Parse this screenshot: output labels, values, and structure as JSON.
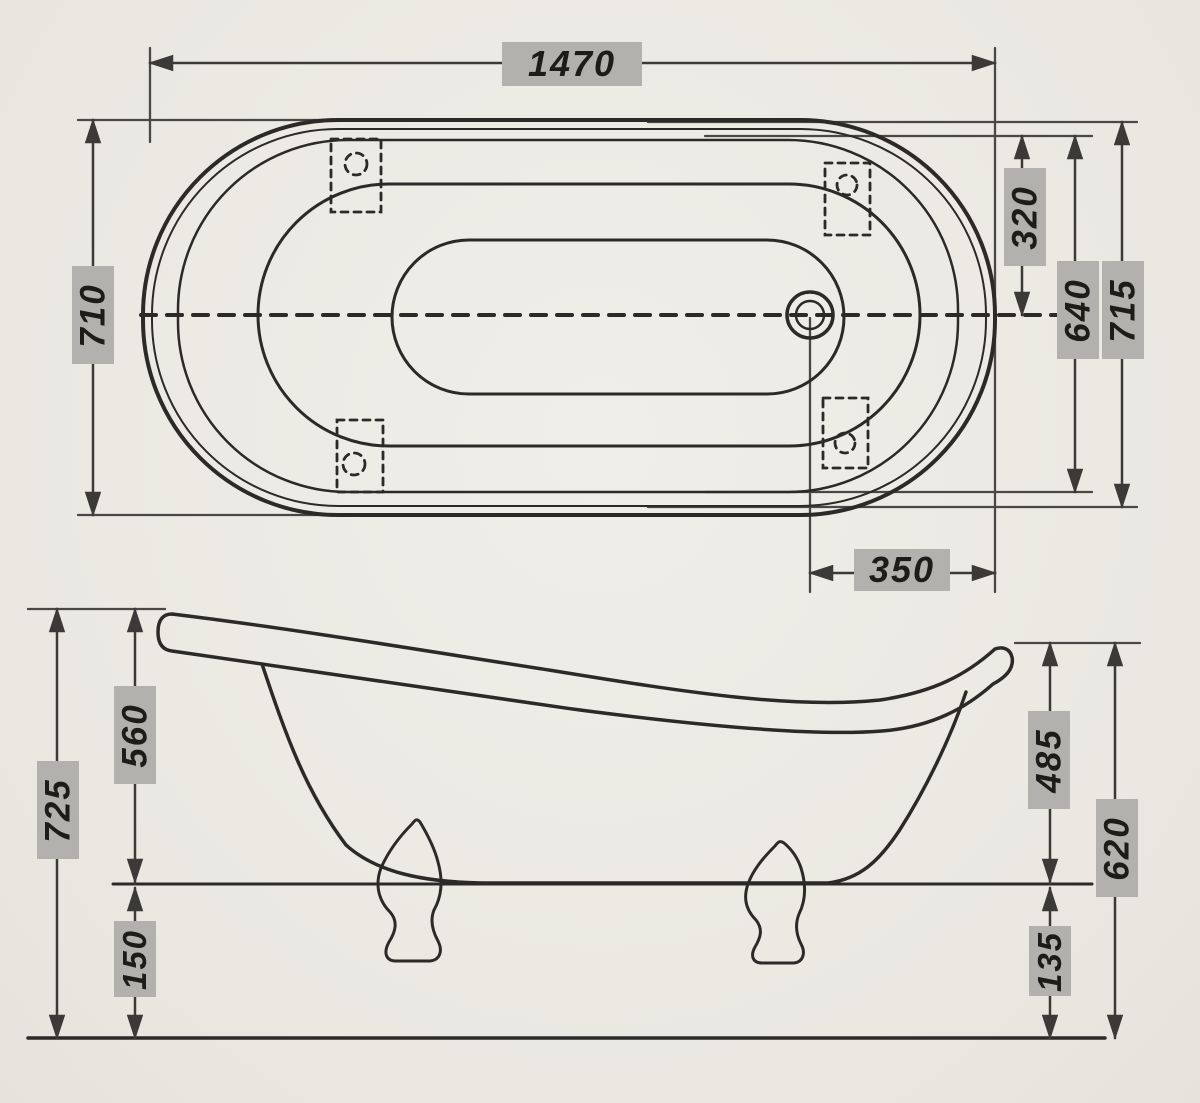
{
  "drawing": {
    "type": "technical dimension drawing",
    "subject": "clawfoot slipper bathtub, top view and side view",
    "units_shown": "mm (numbers only)",
    "views": {
      "top_view": {
        "dimensions": {
          "overall_length": "1470",
          "overall_width_left": "710",
          "rim_edge_to_drain_centerline": "320",
          "inner_rim_width": "640",
          "overall_width_right": "715",
          "drain_center_to_right_end": "350"
        }
      },
      "side_view": {
        "dimensions": {
          "total_height_back_left": "725",
          "rim_to_tub_underside_left": "560",
          "tub_underside_to_floor_left": "150",
          "rim_to_tub_underside_right": "485",
          "total_height_front_right": "620",
          "tub_underside_to_floor_right": "135"
        }
      }
    },
    "colors": {
      "paper": "#eceae4",
      "line": "#2c2a27",
      "dimension_line": "#3c3a37",
      "label_background": "#b2b1ad",
      "label_text": "#1d1c1a"
    }
  }
}
